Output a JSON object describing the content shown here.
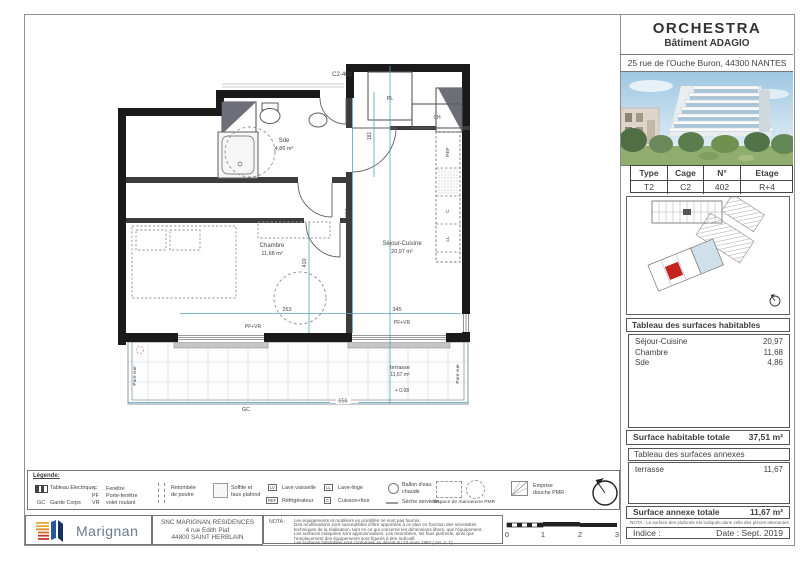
{
  "title_block": {
    "project": "ORCHESTRA",
    "building": "Bâtiment ADAGIO",
    "address": "25 rue de l'Ouche Buron, 44300 NANTES"
  },
  "unit_table": {
    "headers": [
      "Type",
      "Cage",
      "N°",
      "Etage"
    ],
    "values": [
      "T2",
      "C2",
      "402",
      "R+4"
    ]
  },
  "surfaces_habitables": {
    "title": "Tableau des surfaces habitables",
    "rows": [
      {
        "label": "Séjour-Cuisine",
        "value": "20,97"
      },
      {
        "label": "Chambre",
        "value": "11,68"
      },
      {
        "label": "Sde",
        "value": "4,86"
      }
    ],
    "total_label": "Surface habitable totale",
    "total_value": "37,51 m²"
  },
  "surfaces_annexes": {
    "title": "Tableau des surfaces annexes",
    "rows": [
      {
        "label": "terrasse",
        "value": "11,67"
      }
    ],
    "total_label": "Surface annexe totale",
    "total_value": "11,67 m²",
    "nota": "NOTA : La surface des plafonds est indiquée dans celle des pièces attenantes"
  },
  "revision": {
    "indice_label": "Indice :",
    "date_label": "Date : Sept. 2019"
  },
  "plan": {
    "unit_label": "C2-402",
    "rooms": {
      "sde": {
        "name": "Sde",
        "area": "4,86 m²"
      },
      "chambre": {
        "name": "Chambre",
        "area": "11,68 m²"
      },
      "sejour": {
        "name": "Séjour-Cuisine",
        "area": "20,97 m²"
      },
      "terrasse": {
        "name": "terrasse",
        "area": "11,67 m²",
        "level": "+ 0.08"
      }
    },
    "labels": {
      "pl": "PL",
      "ch": "CH",
      "gc": "GC",
      "pare_vue": "Pare vue",
      "pf_vr": "PF+VR",
      "ref": "REF",
      "c": "C",
      "ll": "LL"
    },
    "dims": {
      "v_sejour": "650",
      "v_chambre": "410",
      "v_entree": "181",
      "w_left": "263",
      "w_right": "345",
      "w_terrasse": "656"
    }
  },
  "legend": {
    "title": "Légende:",
    "electrical_label": "Tableau Electrique",
    "abbrevs": [
      {
        "abbr": "F",
        "label": "Fenêtre"
      },
      {
        "abbr": "PF",
        "label": "Porte-fenêtre"
      },
      {
        "abbr": "VR",
        "label": "volet roulant"
      },
      {
        "abbr": "GC",
        "label": "Garde Corps"
      }
    ],
    "beam": {
      "line1": "Retombée",
      "line2": "de poutre"
    },
    "soffit": {
      "line1": "Soffite et",
      "line2": "faux plafond"
    },
    "appliances": [
      {
        "abbr": "LV",
        "label": "Lave vaisselle"
      },
      {
        "abbr": "LL",
        "label": "Lave-linge"
      },
      {
        "abbr": "REF",
        "label": "Réfrigérateur"
      },
      {
        "abbr": "C",
        "label": "Cuisson+four"
      }
    ],
    "water_heater": {
      "line1": "Ballon d'eau",
      "line2": "chaude"
    },
    "towel": "Sèche serviette",
    "pmr_space": "Espace de manoeuvre PMR",
    "pmr_shower": {
      "line1": "Emprise",
      "line2": "douche PMR"
    }
  },
  "footer": {
    "brand": "Marignan",
    "company": "SNC MARIGNAN RESIDENCES",
    "address_line1": "4 rue Edith Piaf",
    "address_line2": "44800 SAINT HERBLAIN",
    "nota_label": "NOTA :",
    "nota_lines": [
      "Les équipements et mobiliers en pointillés ne sont pas fournis.",
      "Des modifications sont susceptibles d'être apportées à ce plan en fonction des nécessités",
      "techniques de la réalisation, tant en ce qui concerne les dimensions libres, que l'équipement.",
      "Les surfaces indiquées sont approximatives. Les retombées, les faux plafonds, ainsi que",
      "l'emplacement des équipements sont figurés à titre indicatif.",
      "Les surfaces habitables sont conformes au décret du 23 mars 1997 ( Art. 4, 1)"
    ],
    "scale_ticks": [
      "0",
      "1",
      "2",
      "3"
    ]
  },
  "colors": {
    "unit_red": "#c4241f",
    "dim_blue": "#4fa3b8"
  }
}
